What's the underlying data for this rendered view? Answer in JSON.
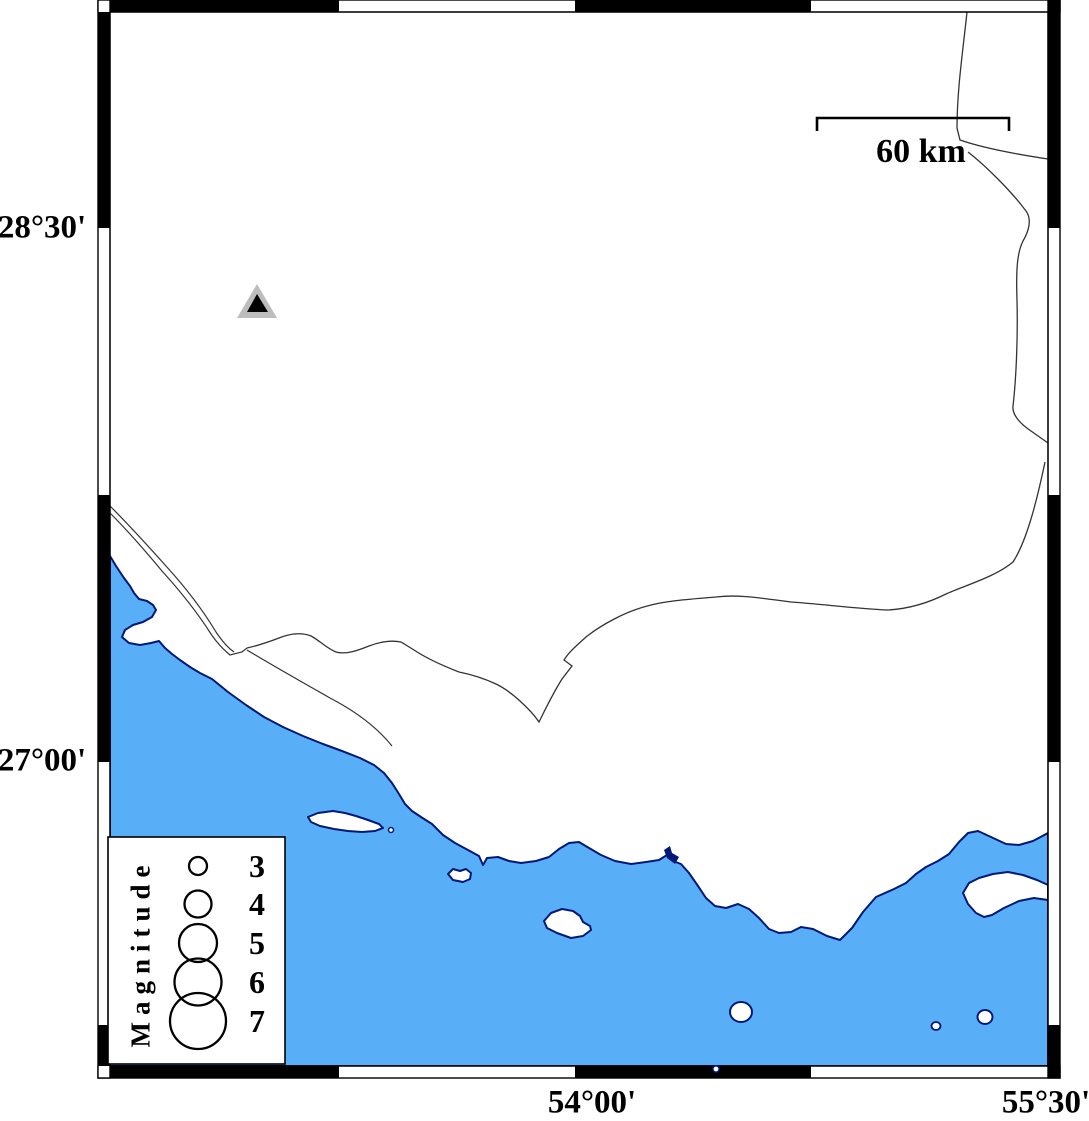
{
  "map": {
    "title": "Seismicity map with station and magnitude legend",
    "axis": {
      "lat_labels": [
        {
          "text": "28°30'"
        },
        {
          "text": "27°00'"
        }
      ],
      "lon_labels": [
        {
          "text": "54°00'"
        },
        {
          "text": "55°30'"
        }
      ]
    },
    "scale_bar": {
      "label": "60 km"
    },
    "legend": {
      "title": "Magnitude",
      "entries": [
        {
          "label": "3"
        },
        {
          "label": "4"
        },
        {
          "label": "5"
        },
        {
          "label": "6"
        },
        {
          "label": "7"
        }
      ]
    },
    "markers": {
      "station_triangle": {
        "shape": "triangle"
      },
      "earthquake_count": "1"
    },
    "colors": {
      "sea": "#58AFF8",
      "coast": "#001878",
      "land_line": "#333333",
      "frame": "#000000",
      "triangle_gray": "#BDBDBD",
      "land": "#ffffff"
    }
  }
}
